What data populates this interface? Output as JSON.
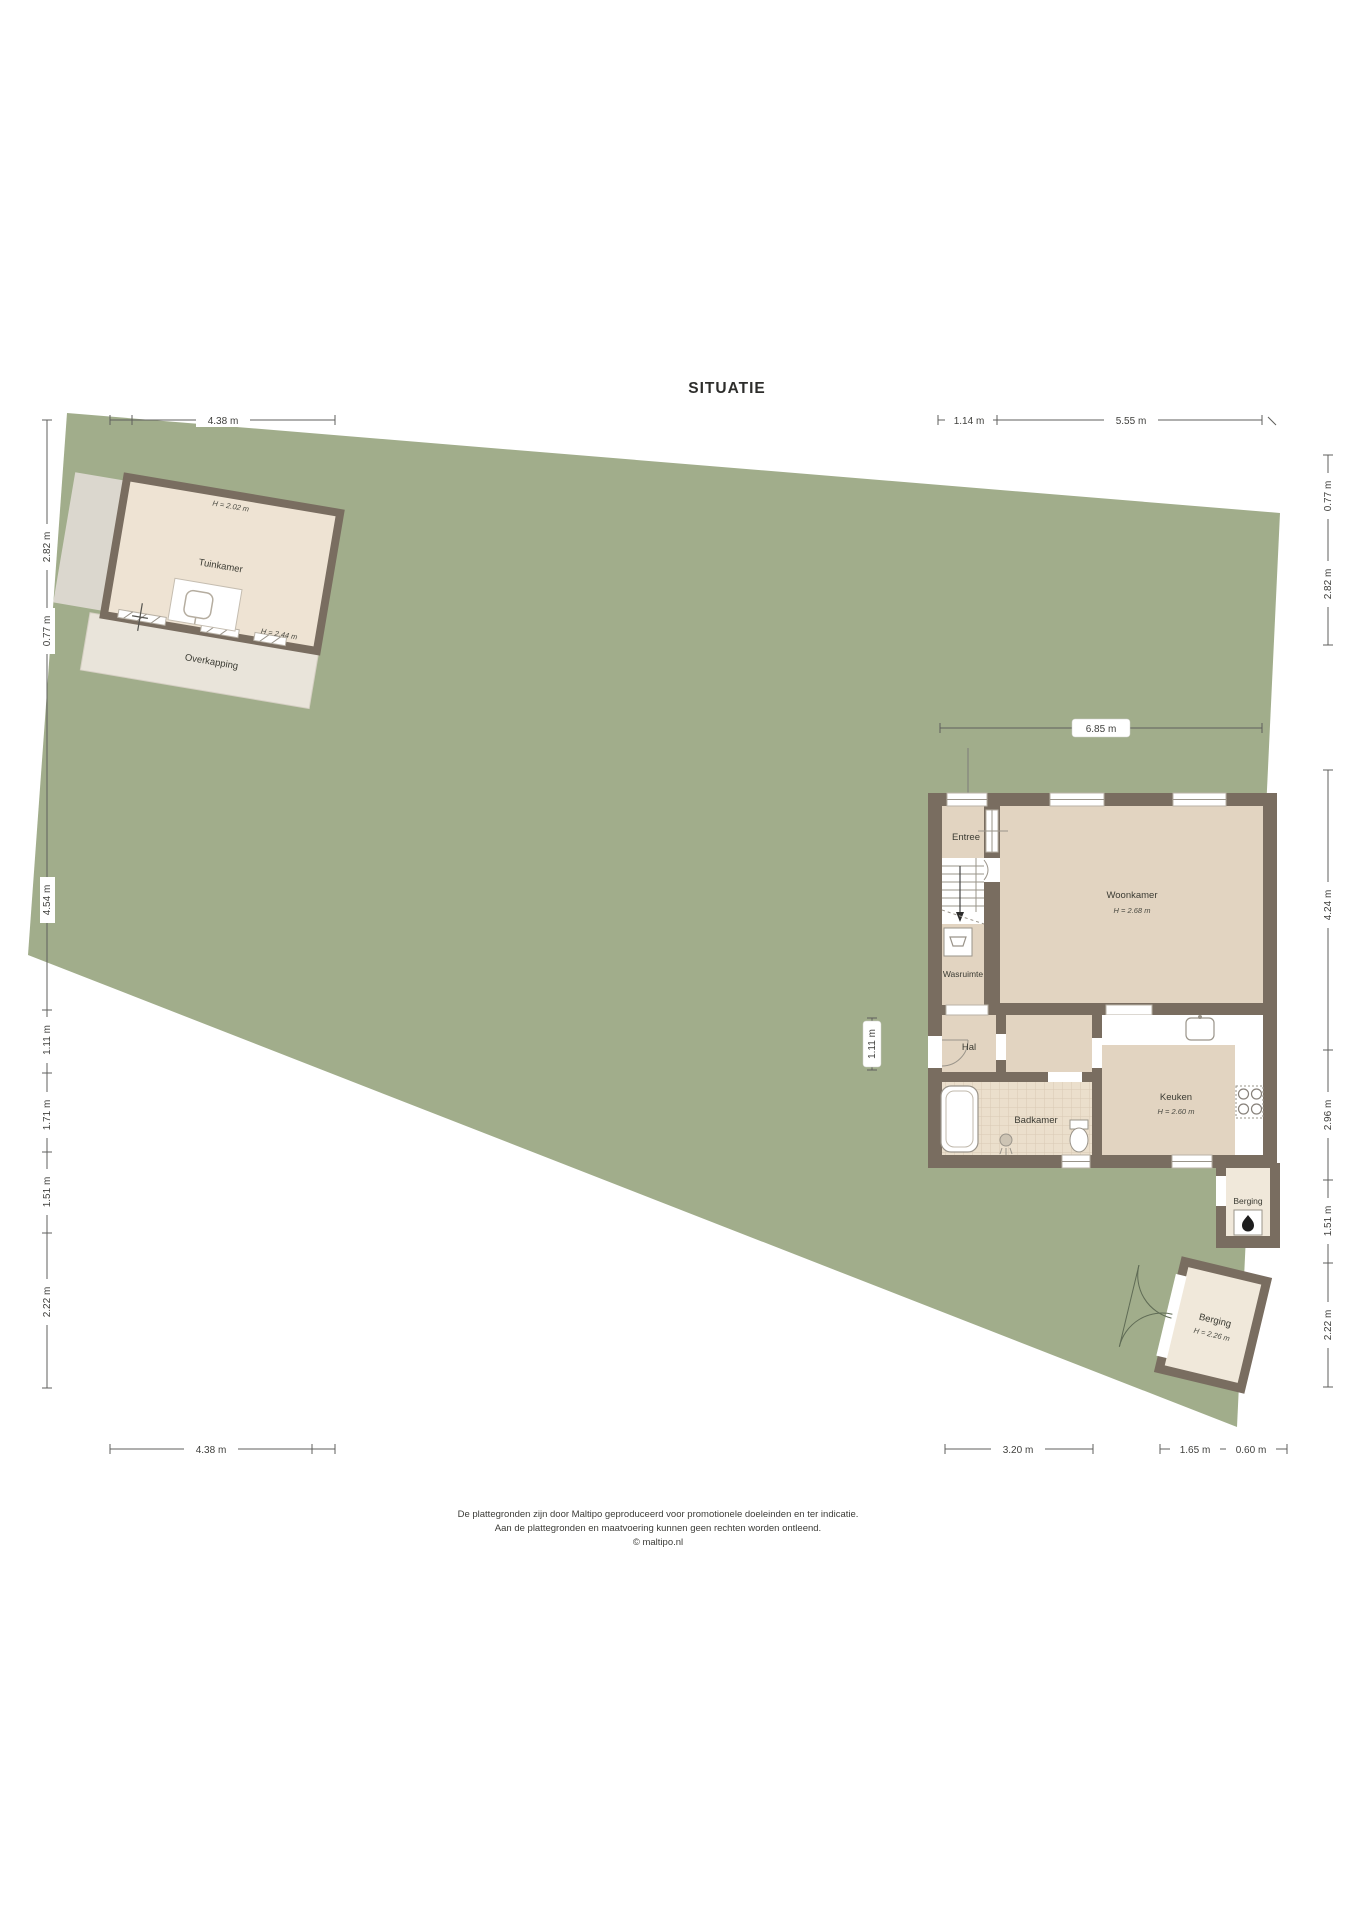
{
  "title": "SITUATIE",
  "garden_house": {
    "label": "Tuinkamer",
    "ceiling_height": "H = 2.02 m",
    "door_height": "H = 2.44 m"
  },
  "overkapping": {
    "label": "Overkapping"
  },
  "house": {
    "entree": {
      "label": "Entree"
    },
    "wasruimte": {
      "label": "Wasruimte"
    },
    "woonkamer": {
      "label": "Woonkamer",
      "ceiling_height": "H = 2.68 m"
    },
    "hal": {
      "label": "Hal"
    },
    "badkamer": {
      "label": "Badkamer"
    },
    "keuken": {
      "label": "Keuken",
      "ceiling_height": "H = 2.60 m"
    },
    "berging_attached": {
      "label": "Berging"
    }
  },
  "berging_detached": {
    "label": "Berging",
    "ceiling_height": "H = 2.26 m"
  },
  "dimensions": {
    "top_left": "4.38 m",
    "top_right_1": "1.14 m",
    "top_right_2": "5.55 m",
    "left_1": "2.82 m",
    "left_2": "0.77 m",
    "left_3": "4.54 m",
    "left_4": "1.11 m",
    "left_5": "1.71 m",
    "left_6": "1.51 m",
    "left_7": "2.22 m",
    "right_1": "0.77 m",
    "right_2": "2.82 m",
    "right_3": "4.24 m",
    "right_4": "2.96 m",
    "right_5": "1.51 m",
    "right_6": "2.22 m",
    "house_width": "6.85 m",
    "entrance_width": "1.11 m",
    "bottom_left": "4.38 m",
    "bottom_right_1": "3.20 m",
    "bottom_right_2": "1.65 m",
    "bottom_right_3": "0.60 m"
  },
  "footer": {
    "line1": "De plattegronden zijn door Maltipo geproduceerd voor promotionele doeleinden en ter indicatie.",
    "line2": "Aan de plattegronden en maatvoering kunnen geen rechten worden ontleend.",
    "line3": "© maltipo.nl"
  },
  "colors": {
    "plot_green": "#a1ad8b",
    "wall": "#796d60",
    "floor_tan": "#e2d4c1",
    "floor_cream": "#f0e8da",
    "tile": "#ebdfcc",
    "overkapping": "#e9e4da",
    "shadow_gray": "#dbd7ce"
  }
}
